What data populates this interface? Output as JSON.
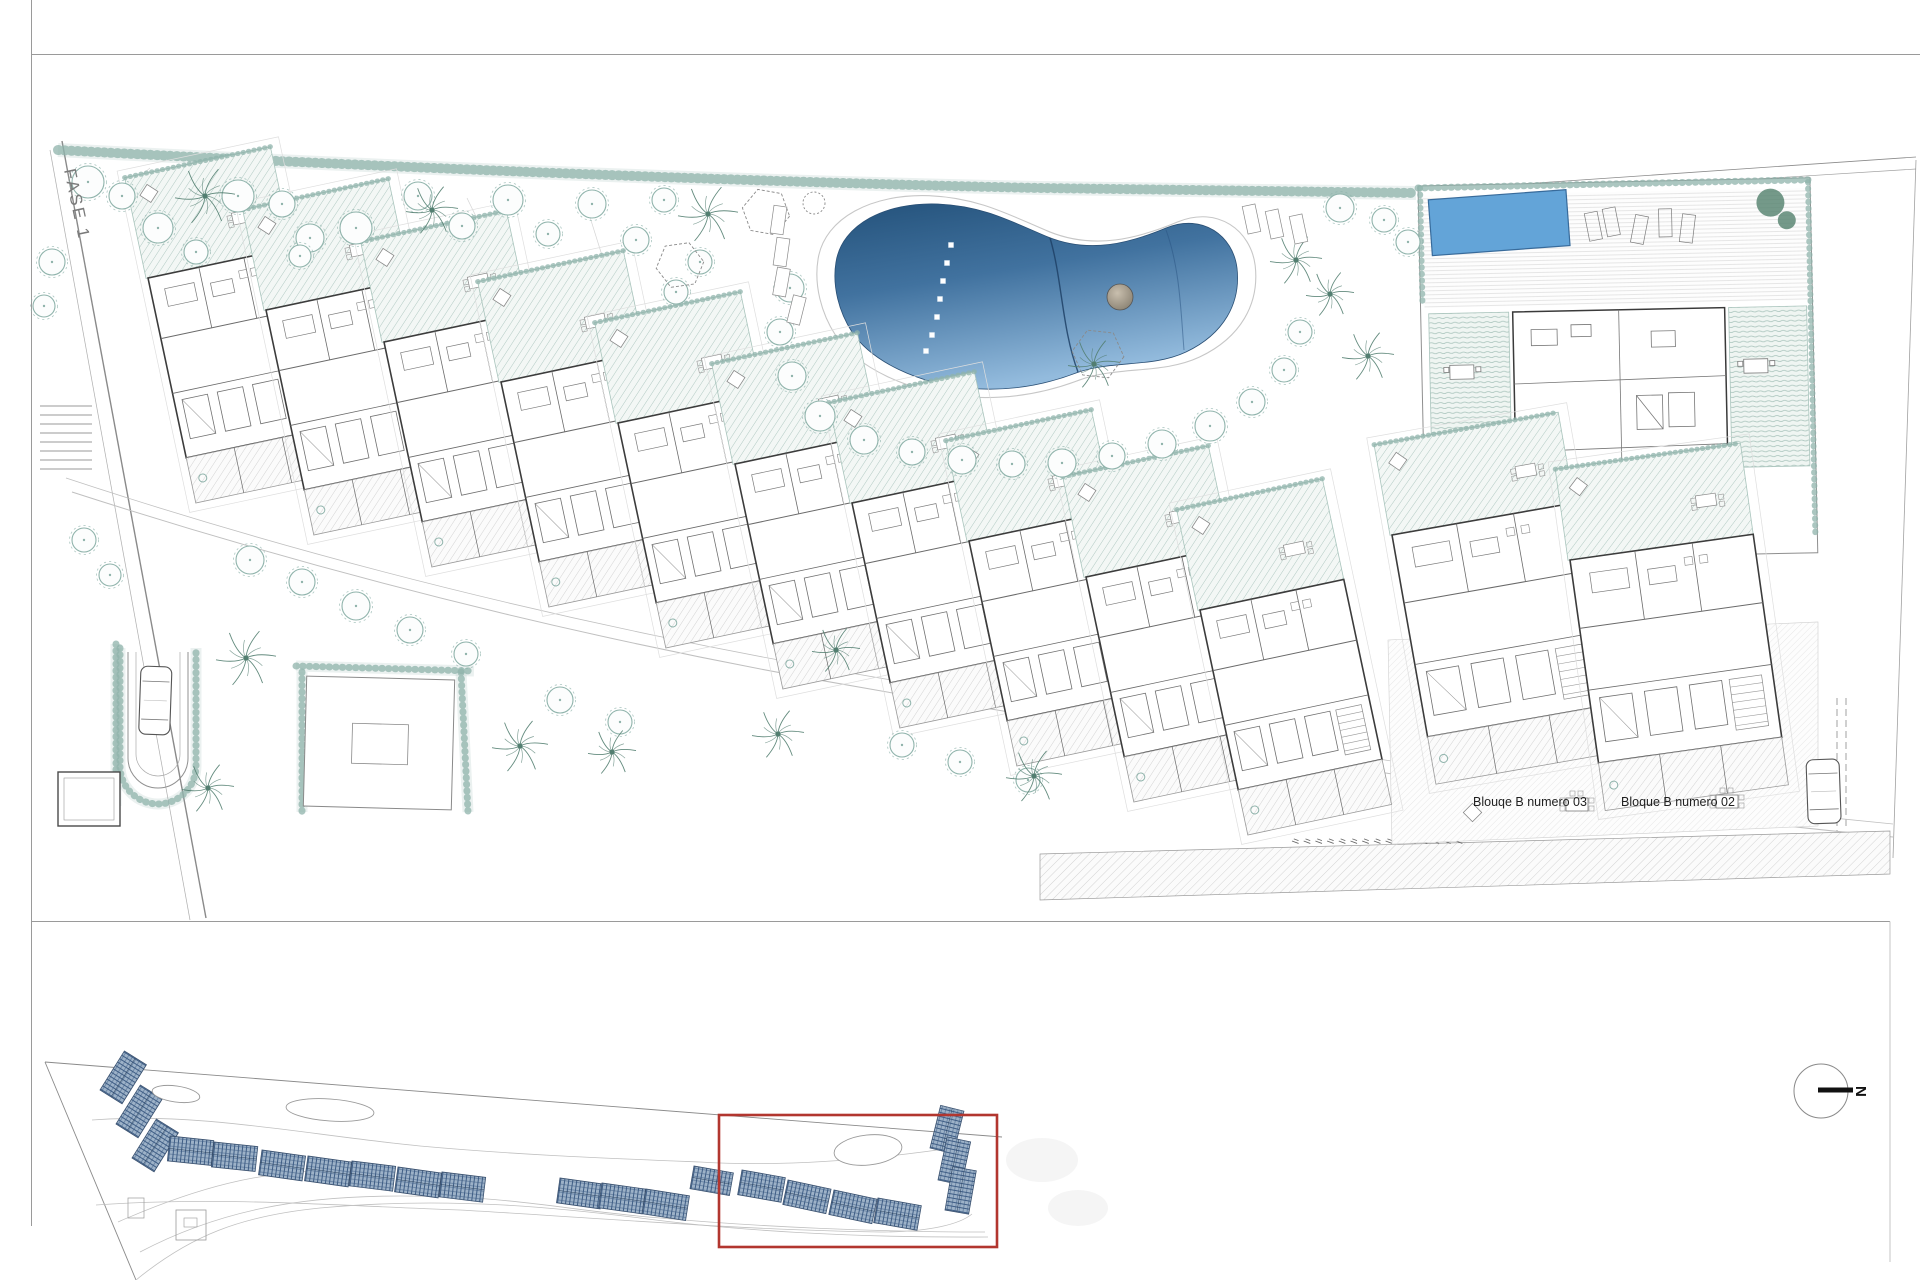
{
  "page": {
    "width": 1920,
    "height": 1280,
    "background": "#ffffff"
  },
  "labels": {
    "phase": "FASE 1",
    "block03": "Blouqe B numero 03",
    "block02": "Bloque B numero 02",
    "north": "N"
  },
  "colors": {
    "accent_red": "#b2362f",
    "veg": "#8fb3ab",
    "veg_dark": "#527e70",
    "hatch_green": "#a9c4bc",
    "hatch_gray": "#c6c6c6",
    "roof_line": "#3e5d85",
    "roof_fill": "#9db2c8",
    "pool_dark": "#24527b",
    "pool_mid": "#41729f",
    "pool_light": "#93bbdd",
    "pool_flat": "#63a4d8",
    "frame_gray": "#9a9a9a",
    "line_dark": "#3c3c3c",
    "line_mid": "#8a8a8a",
    "label_ink": "#1f1f1f",
    "island_light": "#c9bfae",
    "island_dark": "#837b6c"
  },
  "main_plan": {
    "block_style": {
      "w": 147,
      "h": 184,
      "garden_h": 103,
      "terrace_h": 46,
      "rot": -12
    },
    "cluster_style": {
      "w": 185,
      "h": 205,
      "garden_h": 92,
      "terrace_h": 48
    },
    "chain_blocks": [
      [
        148,
        278
      ],
      [
        266,
        310
      ],
      [
        384,
        342
      ],
      [
        501,
        382
      ],
      [
        618,
        423
      ],
      [
        735,
        464
      ],
      [
        852,
        503
      ],
      [
        969,
        541
      ],
      [
        1086,
        577
      ],
      [
        1200,
        610
      ]
    ],
    "cluster_blocks": [
      {
        "x": 1392,
        "y": 535,
        "rot": -10,
        "label": "block03"
      },
      {
        "x": 1570,
        "y": 560,
        "rot": -8,
        "label": "block02"
      }
    ],
    "label_pos": {
      "block03": [
        1473,
        806
      ],
      "block02": [
        1621,
        806
      ]
    },
    "pool_steps": [
      [
        951,
        245
      ],
      [
        947,
        263
      ],
      [
        943,
        281
      ],
      [
        940,
        299
      ],
      [
        937,
        317
      ],
      [
        932,
        335
      ],
      [
        926,
        351
      ]
    ],
    "island": {
      "cx": 1120,
      "cy": 297,
      "r": 13
    },
    "trees": [
      [
        88,
        182,
        16
      ],
      [
        122,
        196,
        13
      ],
      [
        158,
        228,
        15
      ],
      [
        196,
        252,
        12
      ],
      [
        238,
        196,
        16
      ],
      [
        282,
        204,
        13
      ],
      [
        310,
        238,
        14
      ],
      [
        356,
        228,
        16
      ],
      [
        300,
        256,
        11
      ],
      [
        418,
        196,
        14
      ],
      [
        462,
        226,
        13
      ],
      [
        508,
        200,
        15
      ],
      [
        548,
        234,
        12
      ],
      [
        592,
        204,
        14
      ],
      [
        636,
        240,
        13
      ],
      [
        664,
        200,
        12
      ],
      [
        700,
        262,
        12
      ],
      [
        676,
        292,
        12
      ],
      [
        52,
        262,
        13
      ],
      [
        44,
        306,
        11
      ],
      [
        84,
        540,
        12
      ],
      [
        110,
        575,
        11
      ],
      [
        790,
        288,
        14
      ],
      [
        780,
        332,
        13
      ],
      [
        792,
        376,
        14
      ],
      [
        820,
        416,
        15
      ],
      [
        864,
        440,
        14
      ],
      [
        912,
        452,
        13
      ],
      [
        962,
        460,
        14
      ],
      [
        1012,
        464,
        13
      ],
      [
        1062,
        463,
        14
      ],
      [
        1112,
        456,
        13
      ],
      [
        1162,
        444,
        14
      ],
      [
        1210,
        426,
        15
      ],
      [
        1252,
        402,
        13
      ],
      [
        1284,
        370,
        12
      ],
      [
        1300,
        332,
        12
      ],
      [
        1340,
        208,
        14
      ],
      [
        1384,
        220,
        12
      ],
      [
        1408,
        242,
        12
      ],
      [
        250,
        560,
        14
      ],
      [
        302,
        582,
        13
      ],
      [
        356,
        606,
        14
      ],
      [
        410,
        630,
        13
      ],
      [
        466,
        654,
        12
      ],
      [
        560,
        700,
        13
      ],
      [
        620,
        722,
        12
      ],
      [
        902,
        745,
        12
      ],
      [
        960,
        762,
        12
      ],
      [
        1028,
        780,
        12
      ]
    ],
    "palms": [
      [
        205,
        196,
        30
      ],
      [
        432,
        210,
        26
      ],
      [
        708,
        214,
        30
      ],
      [
        1296,
        260,
        26
      ],
      [
        1330,
        294,
        24
      ],
      [
        1368,
        356,
        26
      ],
      [
        1094,
        364,
        26
      ],
      [
        246,
        658,
        30
      ],
      [
        208,
        788,
        26
      ],
      [
        520,
        746,
        28
      ],
      [
        778,
        734,
        26
      ],
      [
        1034,
        776,
        28
      ],
      [
        612,
        752,
        24
      ],
      [
        836,
        650,
        24
      ]
    ],
    "hexagons": [
      [
        766,
        212,
        24,
        10
      ],
      [
        680,
        265,
        24,
        -8
      ],
      [
        1098,
        354,
        26,
        6
      ]
    ],
    "small_circle": {
      "cx": 814,
      "cy": 203,
      "r": 11
    },
    "loungers": [
      [
        772,
        206,
        8
      ],
      [
        775,
        238,
        8
      ],
      [
        775,
        268,
        10
      ],
      [
        790,
        296,
        14
      ],
      [
        1245,
        205,
        -12
      ],
      [
        1268,
        210,
        -12
      ],
      [
        1292,
        215,
        -12
      ]
    ],
    "tables": [
      [
        1566,
        798
      ],
      [
        1716,
        795
      ]
    ],
    "diamonds": [
      [
        1466,
        806
      ]
    ],
    "cars": [
      {
        "x": 141,
        "y": 666,
        "w": 31,
        "h": 68,
        "rot": 2
      },
      {
        "x": 1806,
        "y": 760,
        "w": 33,
        "h": 64,
        "rot": -2
      }
    ],
    "stairs": {
      "x": 40,
      "y": 406,
      "w": 52,
      "count": 8,
      "step": 9
    },
    "parking_ticks": {
      "x": 1292,
      "y": 841,
      "count": 15,
      "step": 11.7
    },
    "hedge_paths": [
      {
        "d": "M58,150 C300,163 700,181 1040,188 L1416,193",
        "w": 10
      },
      {
        "d": "M296,666 L474,671",
        "w": 7
      },
      {
        "d": "M461,672 L468,812",
        "w": 7
      },
      {
        "d": "M302,672 L302,812",
        "w": 7
      },
      {
        "d": "M116,644 L116,806",
        "w": 7
      },
      {
        "d": "M120,648 L120,766 A38 38 0 0 0 196,766 L196,648",
        "w": 7
      }
    ]
  },
  "overview": {
    "roofs": [
      [
        100,
        1090,
        -58,
        46,
        26
      ],
      [
        116,
        1124,
        -58,
        46,
        26
      ],
      [
        132,
        1158,
        -58,
        46,
        26
      ],
      [
        170,
        1136,
        6,
        44,
        25
      ],
      [
        214,
        1142,
        6,
        44,
        25
      ],
      [
        262,
        1150,
        8,
        44,
        25
      ],
      [
        308,
        1156,
        8,
        44,
        25
      ],
      [
        352,
        1161,
        7,
        44,
        25
      ],
      [
        398,
        1167,
        8,
        44,
        25
      ],
      [
        442,
        1172,
        7,
        44,
        25
      ],
      [
        560,
        1178,
        8,
        44,
        25
      ],
      [
        602,
        1183,
        8,
        44,
        25
      ],
      [
        646,
        1189,
        9,
        44,
        25
      ],
      [
        694,
        1166,
        10,
        40,
        23
      ],
      [
        742,
        1170,
        10,
        44,
        25
      ],
      [
        788,
        1180,
        12,
        44,
        25
      ],
      [
        834,
        1190,
        12,
        44,
        25
      ],
      [
        878,
        1198,
        10,
        44,
        25
      ],
      [
        930,
        1148,
        -76,
        44,
        24
      ],
      [
        938,
        1180,
        -78,
        44,
        24
      ],
      [
        945,
        1210,
        -80,
        44,
        24
      ]
    ],
    "pools": [
      {
        "cx": 176,
        "cy": 1094,
        "rx": 24,
        "ry": 8,
        "rot": 8
      },
      {
        "cx": 330,
        "cy": 1110,
        "rx": 44,
        "ry": 11,
        "rot": 4
      },
      {
        "cx": 868,
        "cy": 1150,
        "rx": 34,
        "ry": 15,
        "rot": -6
      }
    ],
    "ghosts": [
      {
        "cx": 1042,
        "cy": 1160,
        "rx": 36,
        "ry": 22
      },
      {
        "cx": 1078,
        "cy": 1208,
        "rx": 30,
        "ry": 18
      }
    ],
    "highlight": {
      "x": 719,
      "y": 1115,
      "w": 278,
      "h": 132
    },
    "north": {
      "cx": 1821,
      "cy": 1091,
      "r": 27
    }
  }
}
